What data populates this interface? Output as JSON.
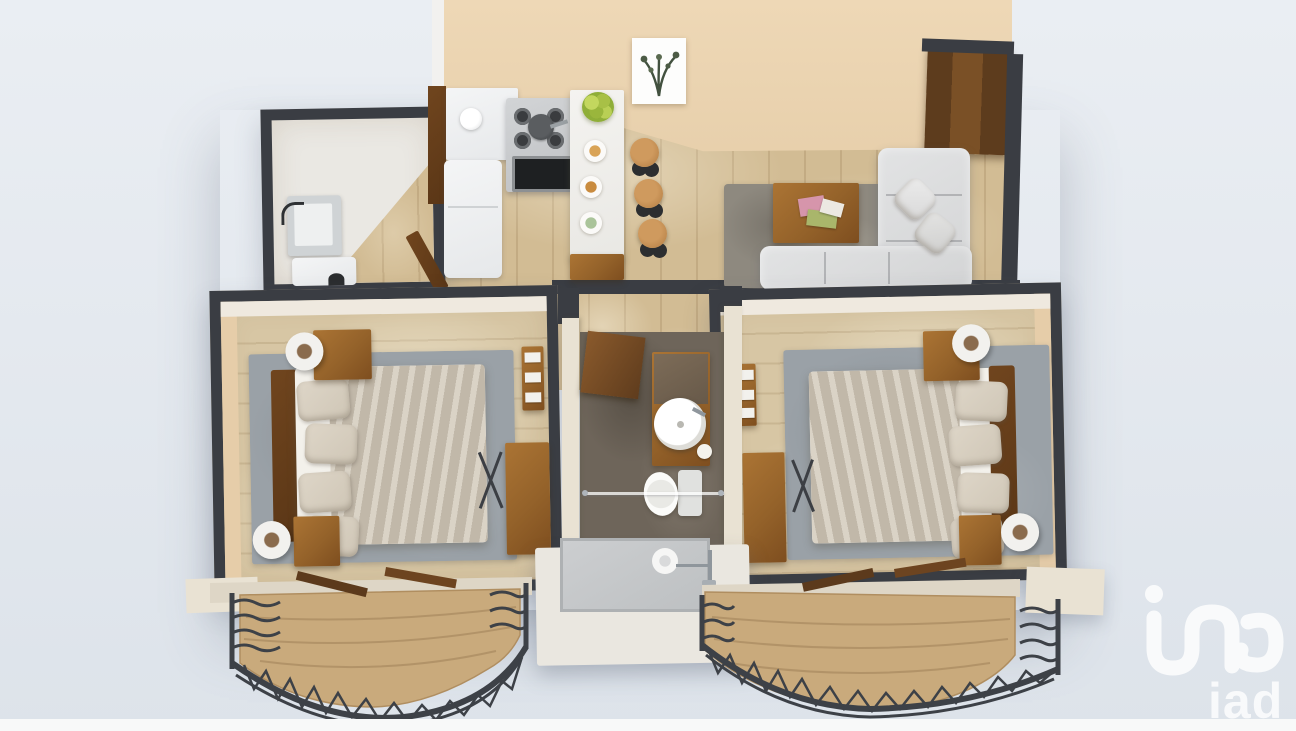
{
  "scene": {
    "title": "3D rendered top-down floor plan of a two-bedroom apartment",
    "style": "dollhouse 3D render, no visible labels",
    "background": "#e3e8ee"
  },
  "watermark": {
    "text": "iad",
    "color": "#ffffff",
    "position": "bottom-right"
  },
  "palette": {
    "wall_dark": "#3a3d43",
    "wall_beige": "#e9d2b0",
    "wall_cream": "#e9e2d3",
    "floor_wood": "#d2bc94",
    "deck_wood": "#c8a87a",
    "rug_gray": "#9aa1a7",
    "rug_living": "#8e897f",
    "tile_bath": "#6e655a",
    "sofa_gray": "#dbdcdc",
    "furniture_wood": "#9a6830",
    "railing_iron": "#3d4147",
    "appliance_steel": "#c6c8ca"
  },
  "rooms": [
    {
      "name": "laundry-room",
      "items": [
        "utility-sink",
        "washing-machine",
        "open-door"
      ]
    },
    {
      "name": "kitchen",
      "items": [
        "refrigerator",
        "gas-stove",
        "oven",
        "counter",
        "breakfast-bar",
        "fruit-bowl",
        "place-settings",
        "bar-stool",
        "bar-stool",
        "bar-stool"
      ]
    },
    {
      "name": "living-room",
      "items": [
        "corner-sofa",
        "throw-pillows",
        "coffee-table",
        "magazines",
        "area-rug",
        "entry-door",
        "wall-art"
      ]
    },
    {
      "name": "bedroom-left",
      "items": [
        "double-bed",
        "headboard",
        "pillows",
        "nightstand",
        "nightstand",
        "lamp",
        "lamp",
        "sideboard",
        "ladder-shelf",
        "luggage-rack",
        "area-rug"
      ]
    },
    {
      "name": "bathroom",
      "items": [
        "vanity",
        "round-basin",
        "toilet",
        "glass-partition",
        "walk-in-shower",
        "shower-fixture"
      ]
    },
    {
      "name": "bedroom-right",
      "items": [
        "double-bed",
        "headboard",
        "pillows",
        "nightstand",
        "nightstand",
        "lamp",
        "lamp",
        "sideboard",
        "ladder-shelf",
        "luggage-rack",
        "area-rug"
      ]
    },
    {
      "name": "balcony-left",
      "items": [
        "curved-wood-deck",
        "wrought-iron-railing",
        "open-french-doors"
      ]
    },
    {
      "name": "balcony-right",
      "items": [
        "curved-wood-deck",
        "wrought-iron-railing",
        "open-french-doors"
      ]
    }
  ]
}
